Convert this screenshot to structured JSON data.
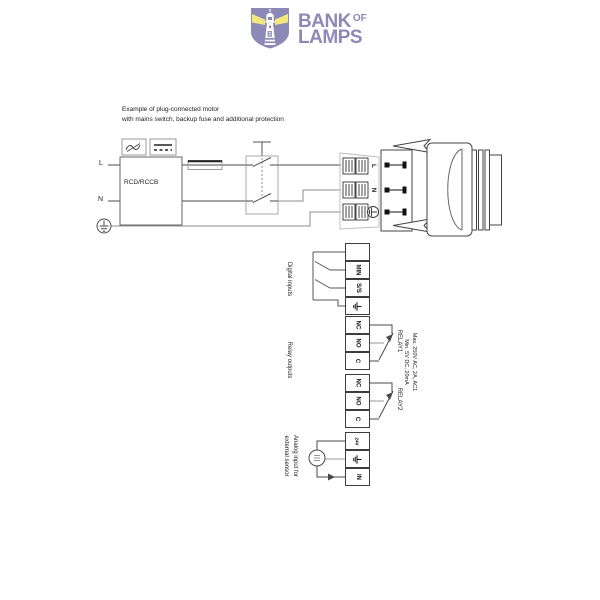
{
  "logo": {
    "title_top": "BANK",
    "title_of": "OF",
    "title_bottom": "LAMPS"
  },
  "diagram": {
    "caption": {
      "line1": "Example of plug-connected motor",
      "line2": "with mains switch, backup fuse and additional protection"
    },
    "mains": {
      "line_label": "L",
      "neutral_label": "N",
      "rcd_label": "RCD/RCCB"
    },
    "plug": {
      "line_label": "L",
      "neutral_label": "N"
    },
    "digital_inputs": {
      "section_label": "Digital inputs",
      "terminal_blank": "",
      "terminal_min": "MIN",
      "terminal_ss": "S/S"
    },
    "relay_outputs": {
      "section_label": "Relay outputs",
      "relay1_label": "RELAY1",
      "relay2_label": "RELAY2",
      "terminal_nc": "NC",
      "terminal_no": "NO",
      "terminal_c": "C",
      "rating_line1": "Max. 250V AC, 2A, AC1",
      "rating_line2": "Min. 5V DC, 20mA"
    },
    "analog_input": {
      "section_label_line1": "Analog input for",
      "section_label_line2": "external sensor",
      "terminal_24v": "24V",
      "terminal_in": "IN"
    }
  },
  "icons": {
    "lighthouse_logo": "shield with lighthouse and yellow light beams",
    "ac_wave": "~",
    "dc_line": "⎓",
    "earth_ground": "⏚",
    "protective_earth": "⏚ in circle",
    "sensor": "circle transducer symbol",
    "plug_arrow": "◁",
    "fuse": "rectangle on line",
    "switch_contact": "blade contact"
  },
  "colors": {
    "brand_purple": "#8d89b6",
    "beam_yellow": "#f2e87f",
    "wire_dark": "#4a4a4a",
    "wire_gray": "#9a9a9a"
  }
}
